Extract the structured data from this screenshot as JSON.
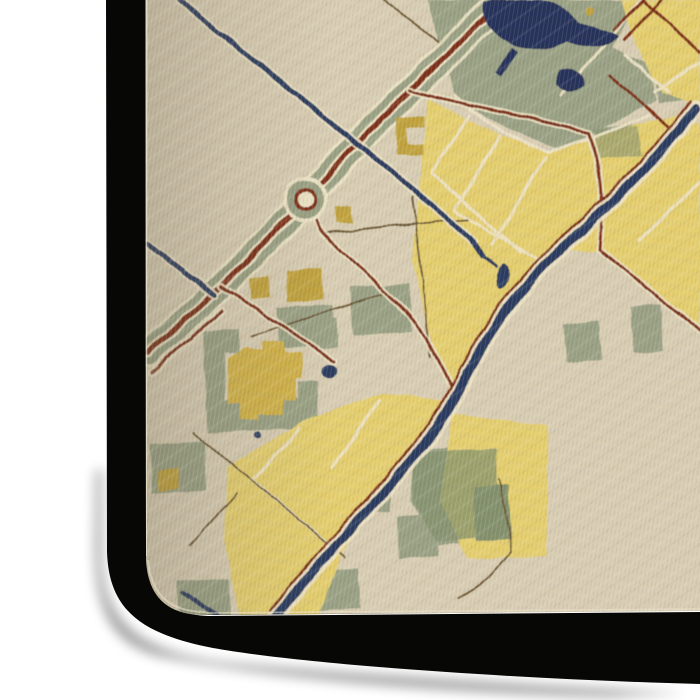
{
  "scene": {
    "object": "gallery-wrapped canvas print, corner view",
    "artwork": "stylized painterly city street map"
  },
  "palette": {
    "background": "#ffffff",
    "face_cream": "#d7ccb2",
    "face_light": "#ece4cf",
    "face_crease": "#3f382b",
    "left_tint": "#6f6650",
    "olive": "#99a083",
    "olive_dark": "#83906c",
    "yellow": "#e3cd6e",
    "yellow_building": "#d0b148",
    "mustard": "#bfa13d",
    "navy": "#2c3a5e",
    "water_navy": "#25335a",
    "maroon": "#7d2f12",
    "road_brown": "#6b5636",
    "street_cream": "#ece2c4",
    "side_black": "#070706",
    "shadow": "#000000"
  }
}
